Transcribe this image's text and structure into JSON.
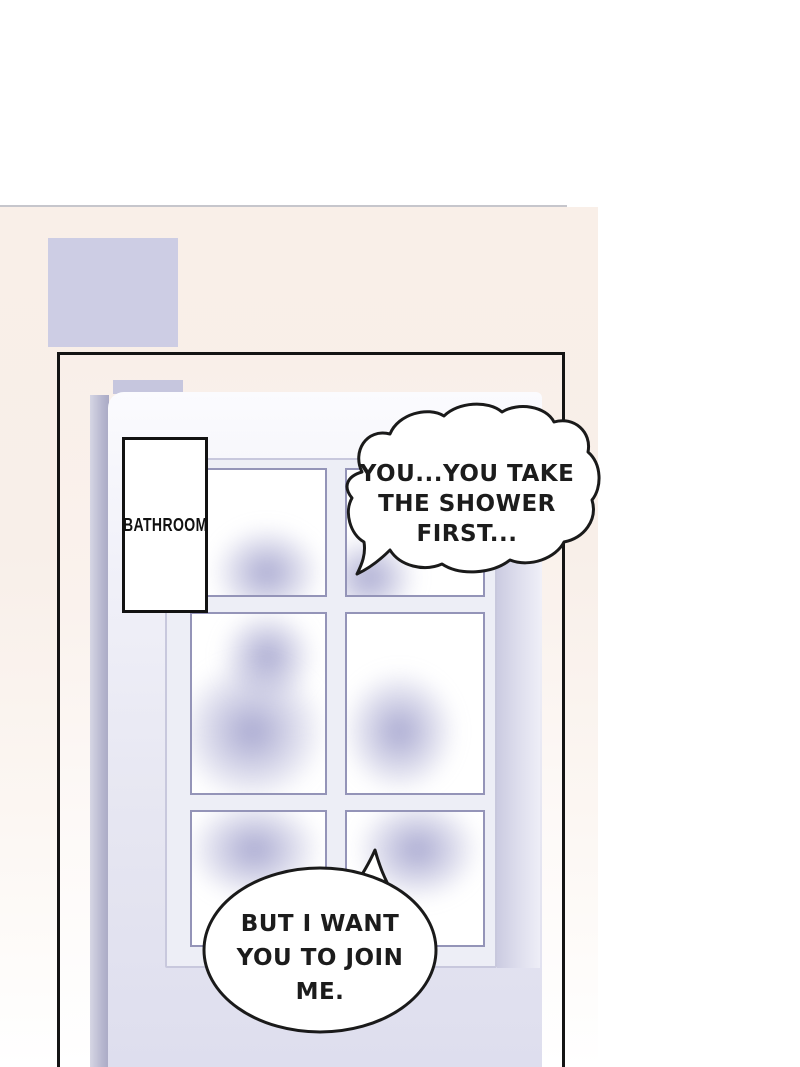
{
  "scene": {
    "sign_label": "BATHROOM",
    "bubble_top_text": "YOU...YOU TAKE\nTHE SHOWER\nFIRST...",
    "bubble_bottom_text": "BUT I WANT\nYOU TO JOIN\nME."
  },
  "colors": {
    "background_top": "#ffffff",
    "background_pink": "#f9efe8",
    "wall_patch_lavender": "#cdcde4",
    "door_face": "#e9e9f4",
    "pane_border": "#9494b8",
    "outline_black": "#1a1a1a"
  }
}
